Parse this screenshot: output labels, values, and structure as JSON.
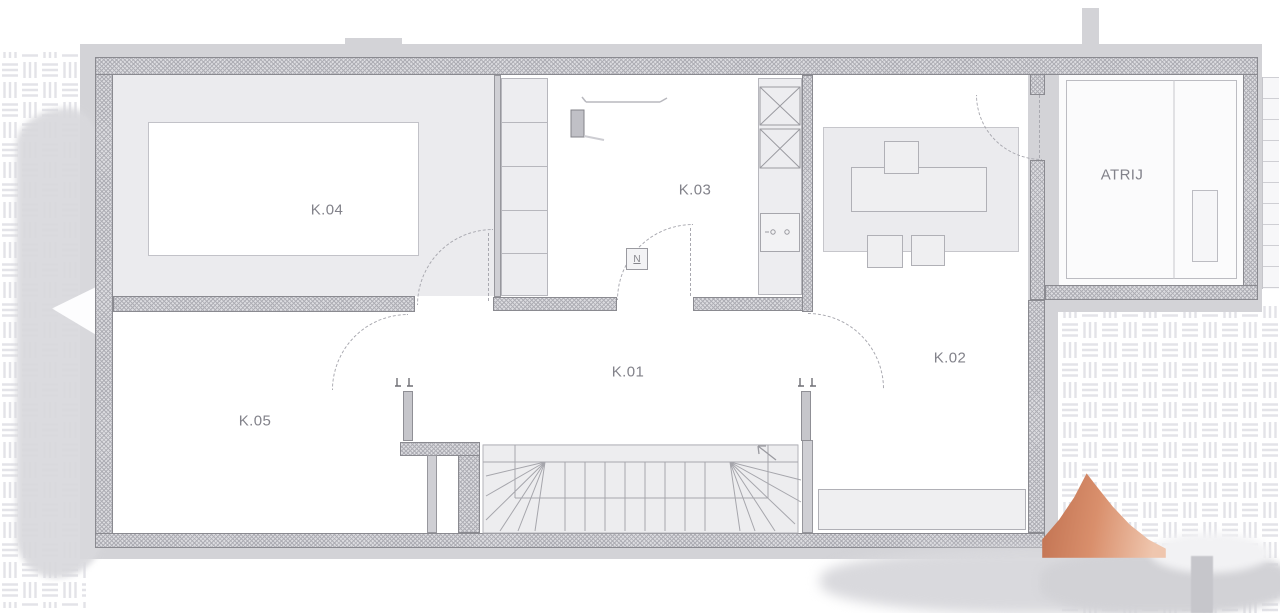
{
  "plan": {
    "type": "architectural-floor-plan",
    "rooms": [
      {
        "id": "k01",
        "label": "K.01"
      },
      {
        "id": "k02",
        "label": "K.02"
      },
      {
        "id": "k03",
        "label": "K.03"
      },
      {
        "id": "k04",
        "label": "K.04"
      },
      {
        "id": "k05",
        "label": "K.05"
      },
      {
        "id": "atrij",
        "label": "ATRIJ"
      }
    ],
    "door_symbol": "N",
    "colors": {
      "wall_fill": "#dcdce0",
      "wall_line": "#8a8a90",
      "room_fill": "#ebebee",
      "surround": "#d3d3d7",
      "paving_line": "#e3e3e8",
      "label_text": "#82828a",
      "accent_orange": "#d98f6c"
    }
  }
}
